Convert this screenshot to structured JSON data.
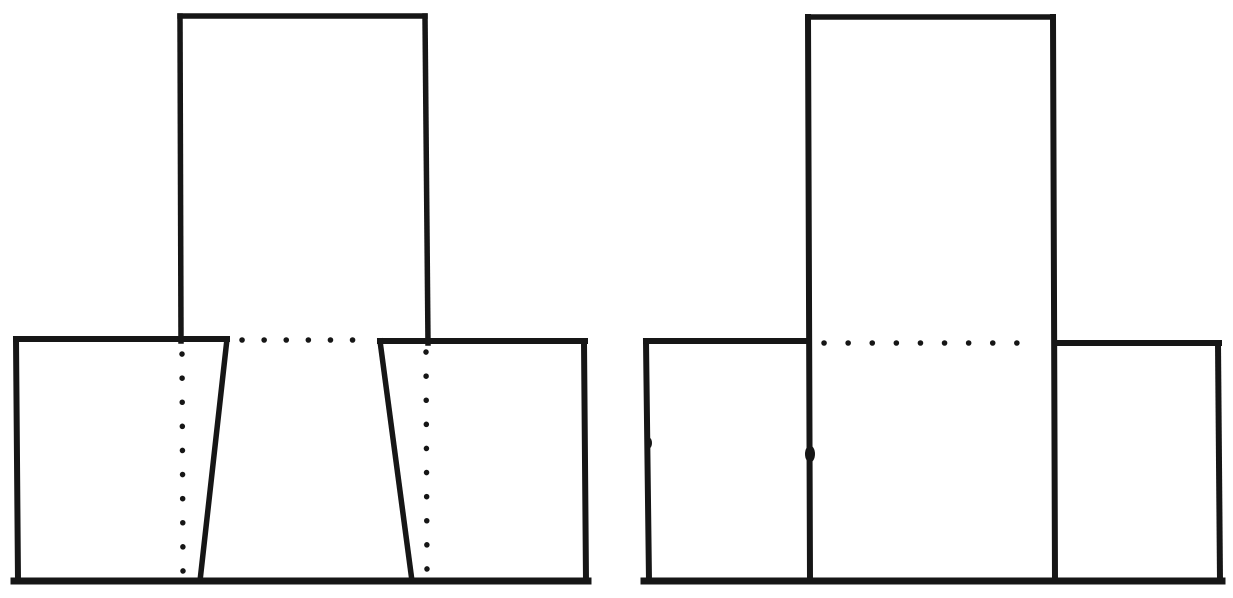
{
  "canvas": {
    "width": 1233,
    "height": 598,
    "background_color": "#ffffff",
    "ink_color": "#161616"
  },
  "figures": [
    {
      "id": "figure-left-tapered-tee-view",
      "solid": [
        [
          180,
          16,
          425,
          16,
          5.5
        ],
        [
          180,
          16,
          181,
          341,
          5.5
        ],
        [
          425,
          16,
          428,
          343,
          5.5
        ],
        [
          16,
          339,
          227,
          339,
          6
        ],
        [
          16,
          339,
          18,
          581,
          6
        ],
        [
          227,
          339,
          200,
          581,
          5.5
        ],
        [
          380,
          341,
          585,
          341,
          6
        ],
        [
          584,
          342,
          586,
          581,
          6
        ],
        [
          380,
          341,
          412,
          581,
          5.5
        ],
        [
          14,
          581,
          588,
          581,
          7
        ]
      ],
      "dotted": [
        [
          242,
          340,
          374,
          340,
          5.5,
          22
        ],
        [
          182,
          354,
          183,
          572,
          5.5,
          24
        ],
        [
          426,
          352,
          427,
          574,
          5.5,
          24
        ]
      ],
      "blobs": []
    },
    {
      "id": "figure-right-straight-tee-view",
      "solid": [
        [
          808,
          17,
          1053,
          17,
          5.5
        ],
        [
          808,
          17,
          810,
          581,
          6
        ],
        [
          1053,
          17,
          1055,
          581,
          6
        ],
        [
          646,
          341,
          808,
          341,
          6
        ],
        [
          646,
          341,
          649,
          581,
          6
        ],
        [
          1055,
          343,
          1219,
          343,
          6
        ],
        [
          1218,
          343,
          1220,
          581,
          6
        ],
        [
          644,
          581,
          1222,
          581,
          7
        ]
      ],
      "dotted": [
        [
          824,
          343,
          1040,
          343,
          5.5,
          24
        ]
      ],
      "blobs": [
        [
          649,
          443,
          3,
          5.5
        ],
        [
          810,
          454,
          5,
          8.5
        ]
      ]
    }
  ]
}
